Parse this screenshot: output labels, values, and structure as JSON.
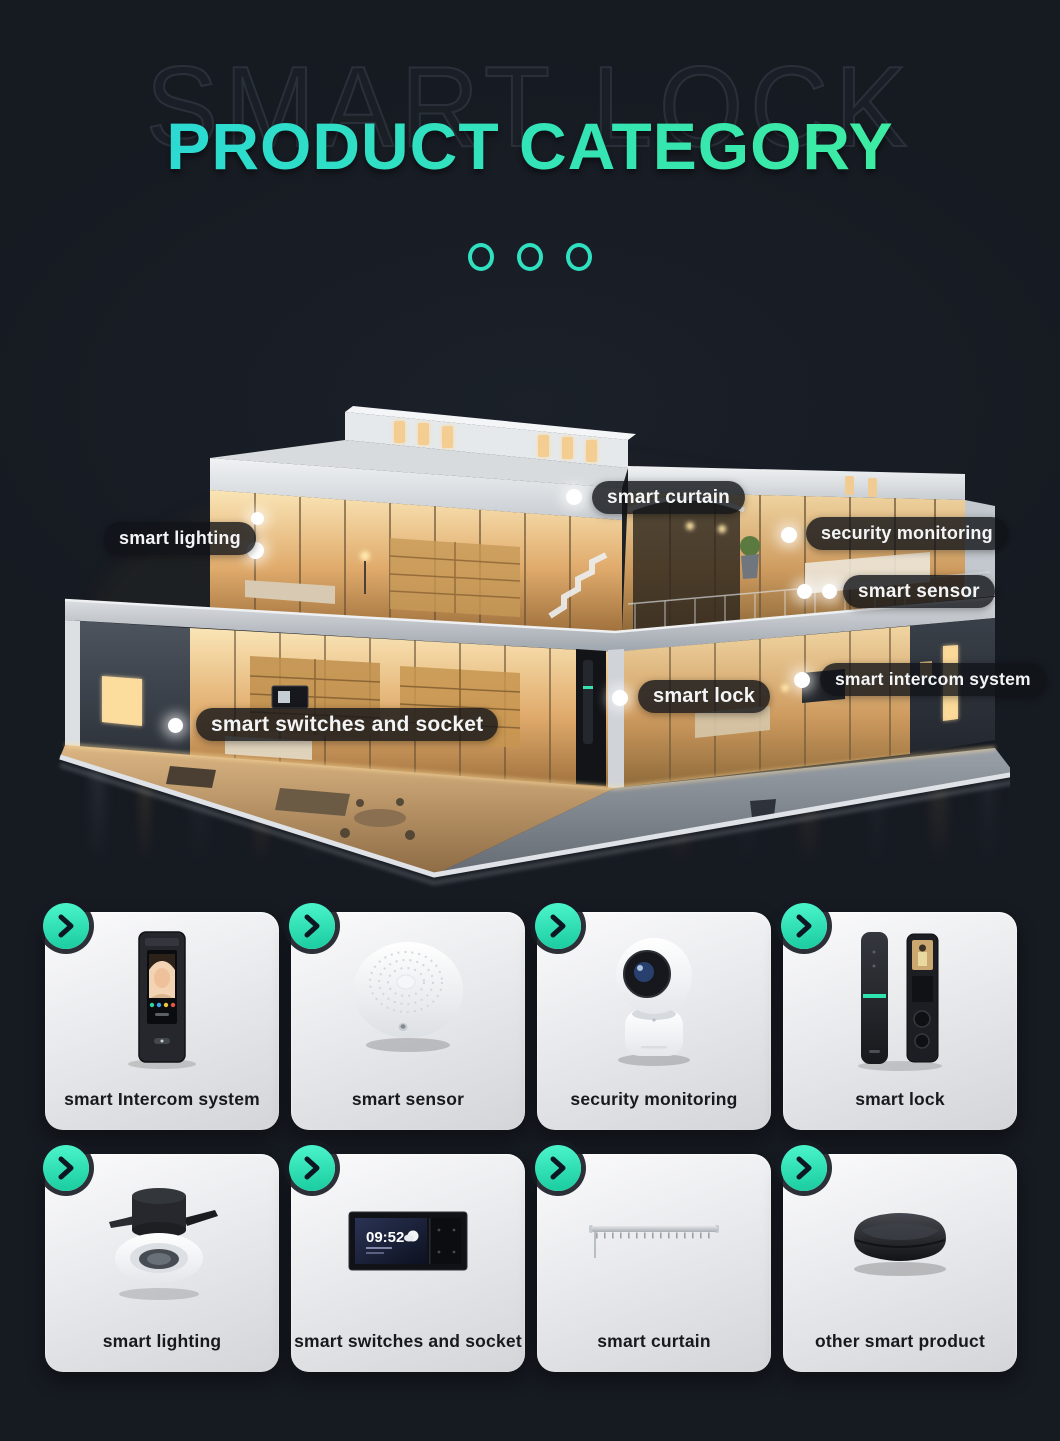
{
  "header": {
    "ghost_text": "SMART LOCK",
    "title": "PRODUCT CATEGORY",
    "pager_dots": 3
  },
  "house": {
    "labels": [
      {
        "text": "smart lighting"
      },
      {
        "text": "smart curtain"
      },
      {
        "text": "security monitoring"
      },
      {
        "text": "smart sensor"
      },
      {
        "text": "smart lock"
      },
      {
        "text": "smart intercom system"
      },
      {
        "text": "smart switches and socket"
      }
    ]
  },
  "cards": [
    {
      "label": "smart Intercom system",
      "art": "face-intercom-panel"
    },
    {
      "label": "smart sensor",
      "art": "round-sensor-puck"
    },
    {
      "label": "security monitoring",
      "art": "ptz-camera"
    },
    {
      "label": "smart lock",
      "art": "door-lock-pair"
    },
    {
      "label": "smart lighting",
      "art": "recessed-downlight"
    },
    {
      "label": "smart switches and socket",
      "art": "wall-switch-screen",
      "screen_time": "09:52"
    },
    {
      "label": "smart curtain",
      "art": "curtain-rail"
    },
    {
      "label": "other smart product",
      "art": "smart-hub"
    }
  ],
  "icons": {
    "card_arrow": "chevron-right",
    "glow_dot": "light-point"
  },
  "colors": {
    "background": "#161a21",
    "accent_teal": "#2fe1c0",
    "title_gradient_start": "#2ad8d8",
    "title_gradient_end": "#41ef9b",
    "label_pill_bg": "rgba(16,19,24,0.8)",
    "card_bg_light": "#fbfbfc",
    "card_bg_dark": "#d3d5d9",
    "glow_dot": "#ffffff"
  }
}
